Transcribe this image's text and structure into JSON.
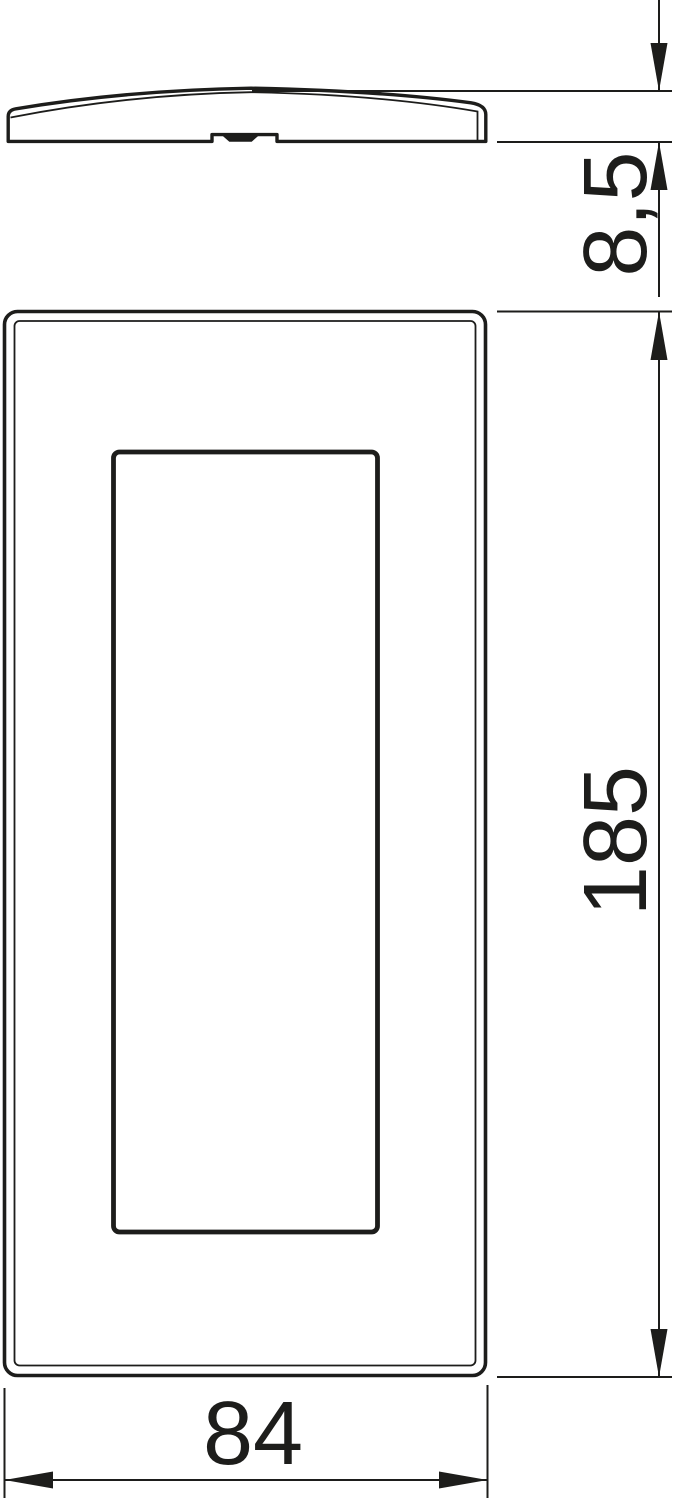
{
  "drawing": {
    "background_color": "#ffffff",
    "line_color": "#1d1d1b",
    "dimensions": {
      "side_thickness": {
        "value": "8,5"
      },
      "front_height": {
        "value": "185"
      },
      "front_width": {
        "value": "84"
      }
    }
  }
}
